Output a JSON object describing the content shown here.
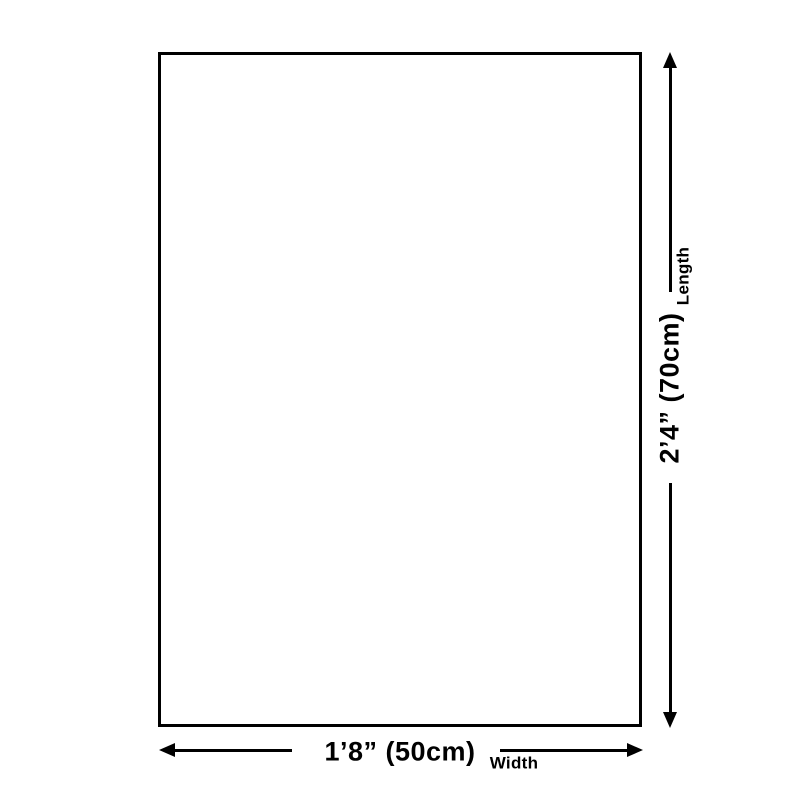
{
  "canvas": {
    "width": 800,
    "height": 800
  },
  "colors": {
    "background": "#ffffff",
    "line": "#000000"
  },
  "diagram": {
    "type": "product-size-diagram",
    "length": {
      "value": "2’4” (70cm)",
      "label": "Length"
    },
    "width": {
      "value": "1’8” (50cm)",
      "label": "Width"
    }
  },
  "icons": {
    "up": "arrow-up-icon",
    "down": "arrow-down-icon",
    "left": "arrow-left-icon",
    "right": "arrow-right-icon"
  }
}
